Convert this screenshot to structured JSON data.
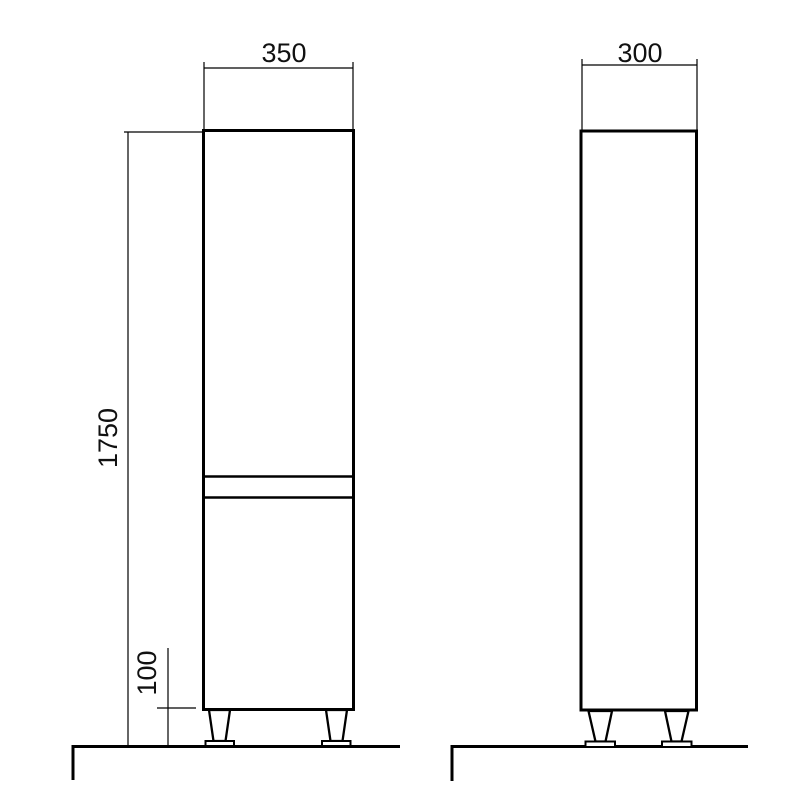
{
  "drawing": {
    "background": "#ffffff",
    "line_color": "#000000",
    "front_view": {
      "width_label": "350",
      "height_label": "1750",
      "leg_height_label": "100"
    },
    "side_view": {
      "depth_label": "300"
    }
  }
}
